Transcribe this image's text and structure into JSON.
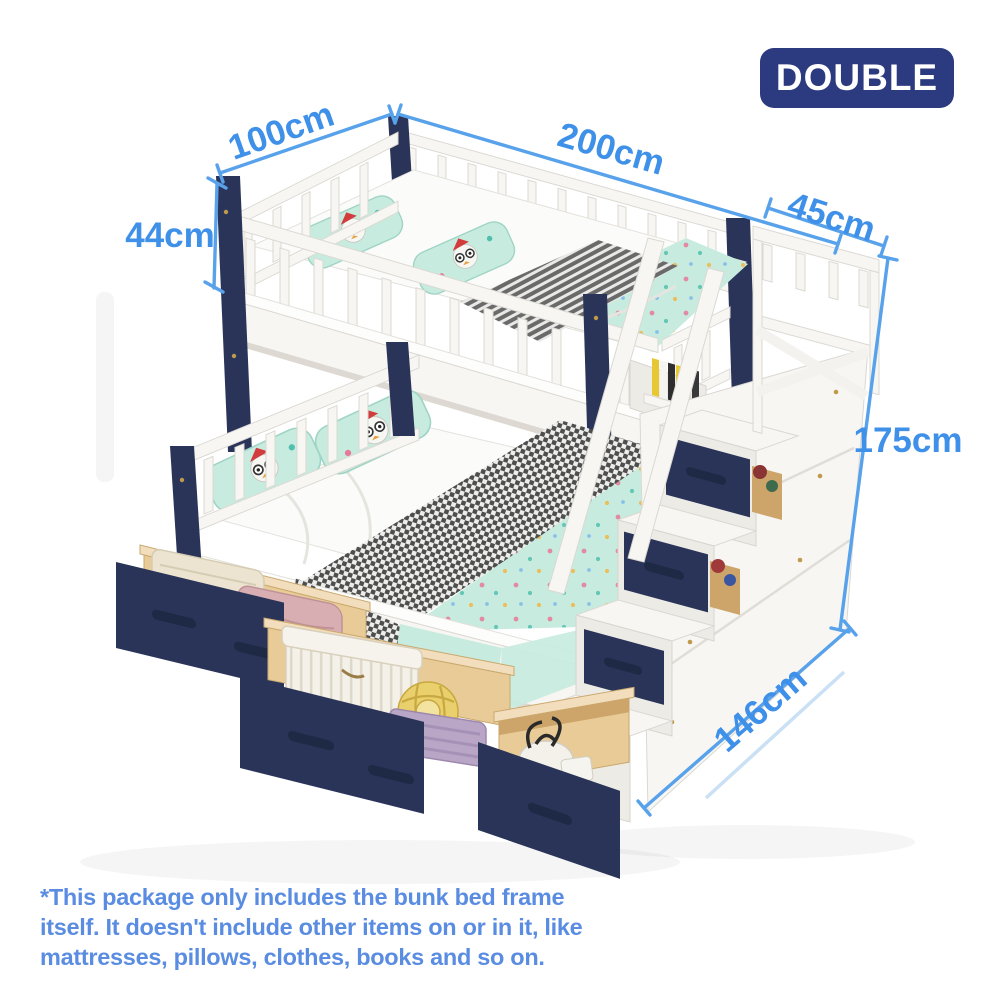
{
  "badge": {
    "label": "DOUBLE"
  },
  "dimensions": {
    "top_bunk_width": "100cm",
    "bed_length": "200cm",
    "stair_depth": "45cm",
    "guardrail_height": "44cm",
    "overall_height": "175cm",
    "bottom_bunk_width": "146cm"
  },
  "disclaimer": {
    "lines": [
      "*This package only includes the bunk bed frame",
      "itself. It doesn't include other items on or in it, like",
      "mattresses, pillows, clothes, books and so on."
    ]
  },
  "colors": {
    "dim-blue": "#58a2eb",
    "dim-text": "#3e90e8",
    "badge-navy": "#2c3a7f",
    "frame-navy": "#2a3459",
    "bedding-mint": "#c7ecdf",
    "drawer-wood": "#e8cb96",
    "note-blue": "#5a8de2"
  }
}
